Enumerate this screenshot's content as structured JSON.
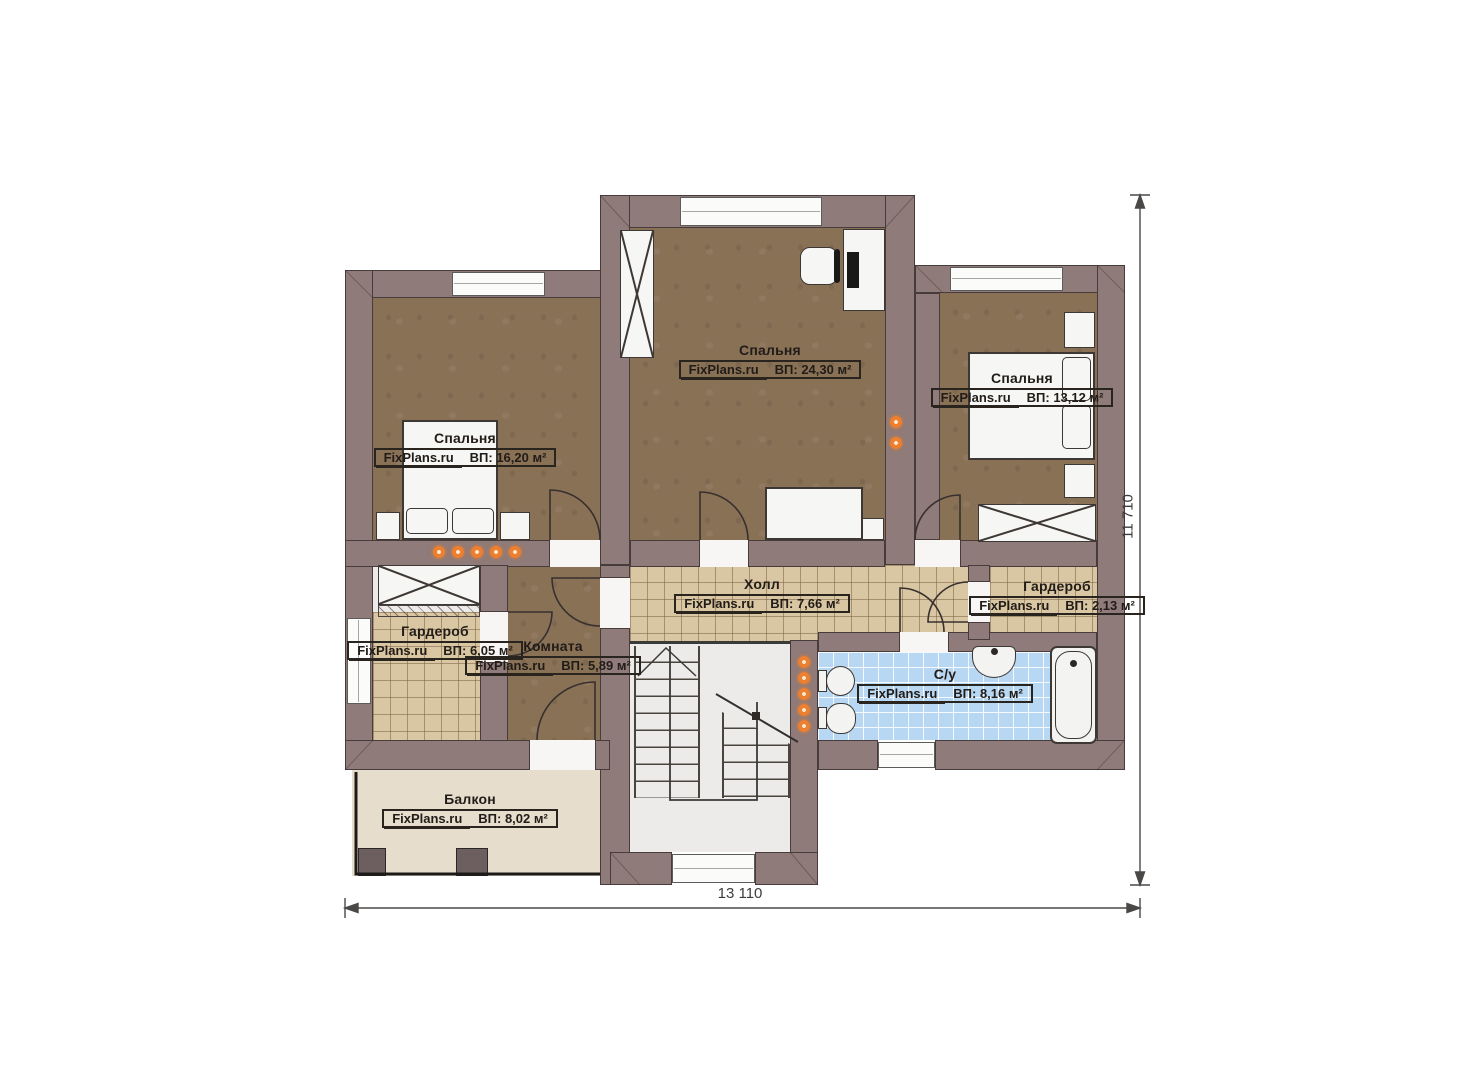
{
  "plan": {
    "watermark": "FixPlans.ru",
    "rooms": [
      {
        "key": "bedroom-top",
        "name": "Спальня",
        "area": "ВП: 24,30 м²"
      },
      {
        "key": "bedroom-left",
        "name": "Спальня",
        "area": "ВП: 16,20 м²"
      },
      {
        "key": "bedroom-right",
        "name": "Спальня",
        "area": "ВП: 13,12 м²"
      },
      {
        "key": "hall",
        "name": "Холл",
        "area": "ВП: 7,66 м²"
      },
      {
        "key": "wardrobe-right",
        "name": "Гардероб",
        "area": "ВП: 2,13 м²"
      },
      {
        "key": "wardrobe-left",
        "name": "Гардероб",
        "area": "ВП: 6,05 м²"
      },
      {
        "key": "room",
        "name": "Комната",
        "area": "ВП: 5,89 м²"
      },
      {
        "key": "bathroom",
        "name": "С/у",
        "area": "ВП: 8,16 м²"
      },
      {
        "key": "balcony",
        "name": "Балкон",
        "area": "ВП: 8,02 м²"
      }
    ],
    "dimensions": {
      "width": "13 110",
      "height": "11 710"
    },
    "colors": {
      "wall": "#8f7b79",
      "floor_wood": "#897156",
      "tile_tan": "#d9c6a2",
      "tile_blue": "#b7d7f2",
      "balcony": "#e6ddcc",
      "heating_dot": "#ee7f2e"
    }
  }
}
